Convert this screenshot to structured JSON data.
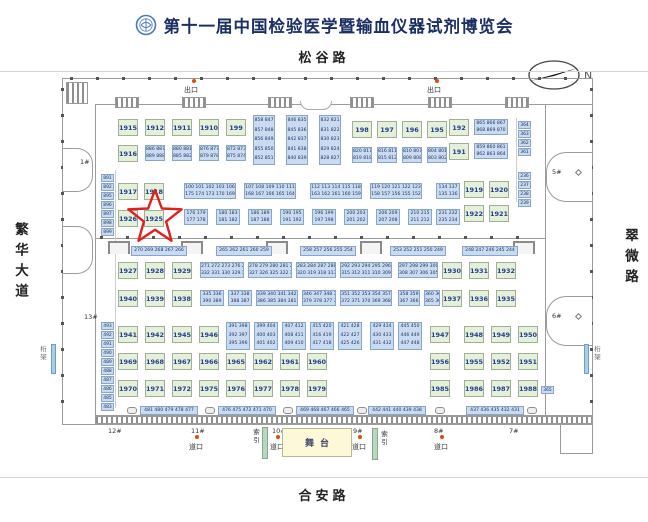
{
  "title": "第十一届中国检验医学暨输血仪器试剂博览会",
  "roads": {
    "top": "松谷路",
    "bottom": "合安路",
    "left": "繁华大道",
    "right": "翠微路"
  },
  "compass_label": "N",
  "legend": {
    "exit": "出口",
    "crossing": "道口",
    "index_chars": [
      "索",
      "引"
    ],
    "stage": "舞台",
    "truss_chars": [
      "桁",
      "架"
    ]
  },
  "star_booth": "1925",
  "colors": {
    "green_booth": "#e4f0da",
    "blue_booth": "#c9dbf1",
    "star": "#e01f1f",
    "stage": "#fcf8d8",
    "index_bar": "#b9d6bf",
    "truss_bar": "#a8cdea",
    "dot": "#e04a10",
    "title": "#1a2f63"
  },
  "map": {
    "green": [
      [
        "1915",
        118,
        119
      ],
      [
        "1912",
        145,
        119
      ],
      [
        "1911",
        172,
        119
      ],
      [
        "1910",
        199,
        119
      ],
      [
        "199",
        226,
        119
      ],
      [
        "1916",
        118,
        145
      ],
      [
        "198",
        352,
        121
      ],
      [
        "197",
        377,
        121
      ],
      [
        "196",
        402,
        121
      ],
      [
        "195",
        427,
        121
      ],
      [
        "192",
        449,
        119
      ],
      [
        "191",
        449,
        143
      ],
      [
        "1917",
        118,
        183
      ],
      [
        "1918",
        144,
        183
      ],
      [
        "1926",
        118,
        210
      ],
      [
        "1925",
        144,
        210
      ],
      [
        "1919",
        464,
        181
      ],
      [
        "1920",
        489,
        181
      ],
      [
        "1922",
        464,
        205
      ],
      [
        "1921",
        489,
        205
      ],
      [
        "1927",
        118,
        262
      ],
      [
        "1928",
        145,
        262
      ],
      [
        "1929",
        172,
        262
      ],
      [
        "1930",
        442,
        262
      ],
      [
        "1931",
        469,
        262
      ],
      [
        "1932",
        496,
        262
      ],
      [
        "1940",
        118,
        290
      ],
      [
        "1939",
        145,
        290
      ],
      [
        "1938",
        172,
        290
      ],
      [
        "1937",
        442,
        290
      ],
      [
        "1936",
        469,
        290
      ],
      [
        "1935",
        496,
        290
      ],
      [
        "1941",
        118,
        326
      ],
      [
        "1942",
        145,
        326
      ],
      [
        "1945",
        172,
        326
      ],
      [
        "1946",
        199,
        326
      ],
      [
        "1947",
        430,
        326
      ],
      [
        "1948",
        464,
        326
      ],
      [
        "1949",
        491,
        326
      ],
      [
        "1950",
        518,
        326
      ],
      [
        "1969",
        118,
        353
      ],
      [
        "1968",
        145,
        353
      ],
      [
        "1967",
        172,
        353
      ],
      [
        "1966",
        199,
        353
      ],
      [
        "1965",
        226,
        353
      ],
      [
        "1962",
        253,
        353
      ],
      [
        "1961",
        280,
        353
      ],
      [
        "1960",
        307,
        353
      ],
      [
        "1956",
        430,
        353
      ],
      [
        "1955",
        464,
        353
      ],
      [
        "1952",
        491,
        353
      ],
      [
        "1951",
        518,
        353
      ],
      [
        "1970",
        118,
        380
      ],
      [
        "1971",
        145,
        380
      ],
      [
        "1972",
        172,
        380
      ],
      [
        "1975",
        199,
        380
      ],
      [
        "1976",
        226,
        380
      ],
      [
        "1977",
        253,
        380
      ],
      [
        "1978",
        280,
        380
      ],
      [
        "1979",
        307,
        380
      ],
      [
        "1985",
        430,
        380
      ],
      [
        "1986",
        464,
        380
      ],
      [
        "1987",
        491,
        380
      ],
      [
        "1988",
        518,
        380
      ]
    ],
    "blue": [
      [
        145,
        145,
        20,
        16,
        [
          "886 887",
          "889 888"
        ]
      ],
      [
        172,
        145,
        20,
        16,
        [
          "880 881",
          "885 882"
        ]
      ],
      [
        199,
        145,
        20,
        16,
        [
          "876 877",
          "879 878"
        ]
      ],
      [
        226,
        145,
        20,
        16,
        [
          "872 873",
          "875 874"
        ]
      ],
      [
        352,
        147,
        20,
        16,
        [
          "820 817",
          "819 818"
        ]
      ],
      [
        377,
        147,
        20,
        16,
        [
          "816 811",
          "815 812"
        ]
      ],
      [
        402,
        147,
        20,
        16,
        [
          "810 807",
          "809 808"
        ]
      ],
      [
        427,
        147,
        20,
        16,
        [
          "804 801",
          "803 802"
        ]
      ],
      [
        253,
        115,
        22,
        50,
        [
          "858 847",
          "857 848",
          "856 849",
          "855 850",
          "852 851"
        ]
      ],
      [
        286,
        115,
        22,
        50,
        [
          "846 835",
          "845 836",
          "842 837",
          "841 838",
          "840 839"
        ]
      ],
      [
        319,
        115,
        22,
        50,
        [
          "832 821",
          "831 822",
          "830 823",
          "829 824",
          "828 827"
        ]
      ],
      [
        474,
        119,
        34,
        16,
        [
          "865 866 867",
          "868 869 870"
        ]
      ],
      [
        474,
        143,
        34,
        16,
        [
          "859 860 861",
          "862 863 864"
        ]
      ],
      [
        184,
        183,
        52,
        16,
        [
          "100 101 102 103 106",
          "175 174 173 170 169"
        ]
      ],
      [
        244,
        183,
        52,
        16,
        [
          "107 108 109 110 111",
          "168 167 166 165 164"
        ]
      ],
      [
        310,
        183,
        52,
        16,
        [
          "112 113 114 115 118",
          "163 162 161 160 159"
        ]
      ],
      [
        370,
        183,
        52,
        16,
        [
          "119 120 121 122 123",
          "158 157 156 155 152"
        ]
      ],
      [
        436,
        183,
        24,
        16,
        [
          "134 137",
          "135 136"
        ]
      ],
      [
        184,
        209,
        24,
        16,
        [
          "176 179",
          "177 178"
        ]
      ],
      [
        216,
        209,
        24,
        16,
        [
          "180 183",
          "181 182"
        ]
      ],
      [
        248,
        209,
        24,
        16,
        [
          "186 189",
          "187 188"
        ]
      ],
      [
        280,
        209,
        24,
        16,
        [
          "190 195",
          "191 192"
        ]
      ],
      [
        312,
        209,
        24,
        16,
        [
          "196 199",
          "197 198"
        ]
      ],
      [
        344,
        209,
        24,
        16,
        [
          "200 203",
          "201 202"
        ]
      ],
      [
        376,
        209,
        24,
        16,
        [
          "206 209",
          "207 208"
        ]
      ],
      [
        408,
        209,
        24,
        16,
        [
          "210 215",
          "211 212"
        ]
      ],
      [
        436,
        209,
        24,
        16,
        [
          "231 232",
          "235 234"
        ]
      ],
      [
        131,
        246,
        56,
        10,
        [
          "270 269 268 267 266"
        ]
      ],
      [
        216,
        246,
        56,
        10,
        [
          "265 262 261 260 259"
        ]
      ],
      [
        300,
        246,
        56,
        10,
        [
          "258 257 256 255 254"
        ]
      ],
      [
        390,
        246,
        56,
        10,
        [
          "253 252 251 250 249"
        ]
      ],
      [
        462,
        246,
        56,
        10,
        [
          "248 247 246 245 244"
        ]
      ],
      [
        200,
        262,
        44,
        16,
        [
          "271 272 273 276 277",
          "332 331 330 329 328"
        ]
      ],
      [
        248,
        262,
        44,
        16,
        [
          "278 279 280 281 282",
          "327 326 325 322 321"
        ]
      ],
      [
        296,
        262,
        40,
        16,
        [
          "283 284 287 288 291",
          "320 319 318 317 316"
        ]
      ],
      [
        340,
        262,
        52,
        16,
        [
          "292 293 294 295 296",
          "315 312 311 310 309"
        ]
      ],
      [
        398,
        262,
        40,
        16,
        [
          "297 298 299 300 301",
          "308 307 306 305 302"
        ]
      ],
      [
        200,
        290,
        24,
        16,
        [
          "335 336",
          "390 389"
        ]
      ],
      [
        228,
        290,
        24,
        16,
        [
          "337 338",
          "388 387"
        ]
      ],
      [
        256,
        290,
        42,
        16,
        [
          "339 340 341 342 345",
          "386 385 384 381 380"
        ]
      ],
      [
        302,
        290,
        34,
        16,
        [
          "346 347 348 349 350",
          "379 378 377 376 375"
        ]
      ],
      [
        340,
        290,
        52,
        16,
        [
          "351 352 353 354 357",
          "372 371 370 369 368"
        ]
      ],
      [
        398,
        290,
        22,
        16,
        [
          "358 359",
          "367 366"
        ]
      ],
      [
        424,
        290,
        16,
        16,
        [
          "360 361",
          "365 362"
        ]
      ],
      [
        226,
        322,
        24,
        28,
        [
          "391 398",
          "392 397",
          "395 396"
        ]
      ],
      [
        254,
        322,
        24,
        28,
        [
          "399 404",
          "400 403",
          "401 402"
        ]
      ],
      [
        282,
        322,
        24,
        28,
        [
          "407 412",
          "408 411",
          "409 410"
        ]
      ],
      [
        310,
        322,
        24,
        28,
        [
          "415 420",
          "416 419",
          "417 418"
        ]
      ],
      [
        338,
        322,
        24,
        28,
        [
          "421 428",
          "422 427",
          "425 426"
        ]
      ],
      [
        370,
        322,
        24,
        28,
        [
          "429 434",
          "430 433",
          "431 432"
        ]
      ],
      [
        398,
        322,
        24,
        28,
        [
          "445 450",
          "446 449",
          "447 448"
        ]
      ],
      [
        140,
        406,
        58,
        9,
        [
          "481 480 479 478 477"
        ]
      ],
      [
        218,
        406,
        58,
        9,
        [
          "476 475 472 471 470"
        ]
      ],
      [
        296,
        406,
        58,
        9,
        [
          "469 468 467 466 465"
        ]
      ],
      [
        368,
        406,
        58,
        9,
        [
          "442 441 440 439 438"
        ]
      ],
      [
        466,
        406,
        58,
        9,
        [
          "437 436 435 432 431"
        ]
      ]
    ],
    "cells": [
      [
        "891",
        101,
        174
      ],
      [
        "892",
        101,
        183
      ],
      [
        "895",
        101,
        192
      ],
      [
        "896",
        101,
        201
      ],
      [
        "897",
        101,
        210
      ],
      [
        "898",
        101,
        219
      ],
      [
        "899",
        101,
        228
      ],
      [
        "493",
        101,
        322
      ],
      [
        "492",
        101,
        331
      ],
      [
        "491",
        101,
        340
      ],
      [
        "490",
        101,
        349
      ],
      [
        "489",
        101,
        358
      ],
      [
        "488",
        101,
        367
      ],
      [
        "487",
        101,
        376
      ],
      [
        "486",
        101,
        385
      ],
      [
        "485",
        101,
        394
      ],
      [
        "483",
        101,
        403
      ],
      [
        "364",
        518,
        121
      ],
      [
        "363",
        518,
        130
      ],
      [
        "362",
        518,
        139
      ],
      [
        "361",
        518,
        148
      ],
      [
        "236",
        518,
        172
      ],
      [
        "237",
        518,
        181
      ],
      [
        "238",
        518,
        190
      ],
      [
        "239",
        518,
        199
      ],
      [
        "365",
        541,
        386
      ]
    ],
    "halls": [
      [
        "1#",
        80,
        158
      ],
      [
        "13#",
        84,
        313
      ],
      [
        "5#",
        552,
        168
      ],
      [
        "6#",
        552,
        312
      ],
      [
        "12#",
        108,
        427
      ],
      [
        "11#",
        191,
        427
      ],
      [
        "10#",
        272,
        427
      ],
      [
        "9#",
        353,
        427
      ],
      [
        "8#",
        434,
        427
      ],
      [
        "7#",
        509,
        427
      ]
    ],
    "exits": [
      [
        184,
        85
      ],
      [
        427,
        85
      ]
    ],
    "crossings": [
      [
        189,
        442
      ],
      [
        270,
        442
      ],
      [
        352,
        442
      ],
      [
        434,
        442
      ]
    ],
    "index_strips": [
      {
        "bar": [
          262,
          427
        ],
        "text": [
          252,
          429
        ]
      },
      {
        "bar": [
          372,
          428
        ],
        "text": [
          380,
          431
        ]
      }
    ],
    "stage": {
      "x": 282,
      "y": 428,
      "w": 70,
      "h": 29
    },
    "trusses": [
      {
        "bar": [
          51,
          344
        ],
        "text": [
          39,
          346
        ]
      },
      {
        "bar": [
          584,
          344
        ],
        "text": [
          593,
          346
        ]
      }
    ]
  }
}
